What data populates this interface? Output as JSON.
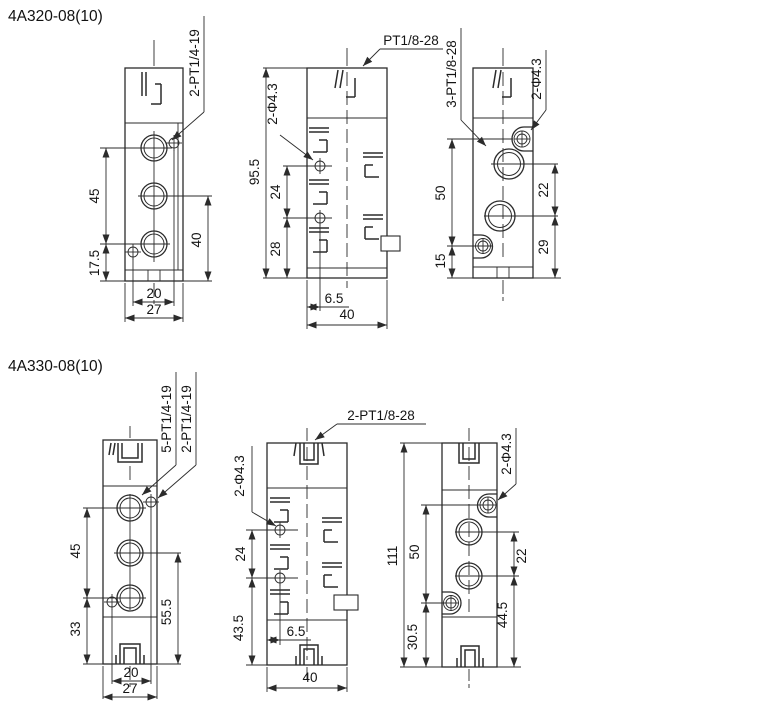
{
  "colors": {
    "background": "#ffffff",
    "line": "#2b2b2b",
    "text": "#141414"
  },
  "drawings": [
    {
      "title": "4A320-08(10)",
      "views": {
        "left": {
          "port_label": "2-PT1/4-19",
          "dim_45": "45",
          "dim_17_5": "17.5",
          "dim_40": "40",
          "dim_20": "20",
          "dim_27": "27"
        },
        "middle": {
          "port_label": "PT1/8-28",
          "hole_label": "2-Φ4.3",
          "dim_95_5": "95.5",
          "dim_24": "24",
          "dim_28": "28",
          "dim_6_5": "6.5",
          "dim_40": "40"
        },
        "right": {
          "port_label": "3-PT1/8-28",
          "hole_label": "2-Φ4.3",
          "dim_50": "50",
          "dim_15": "15",
          "dim_22": "22",
          "dim_29": "29"
        }
      }
    },
    {
      "title": "4A330-08(10)",
      "views": {
        "left": {
          "port_label_5": "5-PT1/4-19",
          "port_label_2": "2-PT1/4-19",
          "dim_45": "45",
          "dim_33": "33",
          "dim_55_5": "55.5",
          "dim_20": "20",
          "dim_27": "27"
        },
        "middle": {
          "port_label": "2-PT1/8-28",
          "hole_label": "2-Φ4.3",
          "dim_24": "24",
          "dim_43_5": "43.5",
          "dim_6_5": "6.5",
          "dim_40": "40"
        },
        "right": {
          "hole_label": "2-Φ4.3",
          "dim_111": "111",
          "dim_50": "50",
          "dim_30_5": "30.5",
          "dim_22": "22",
          "dim_44_5": "44.5"
        }
      }
    }
  ]
}
